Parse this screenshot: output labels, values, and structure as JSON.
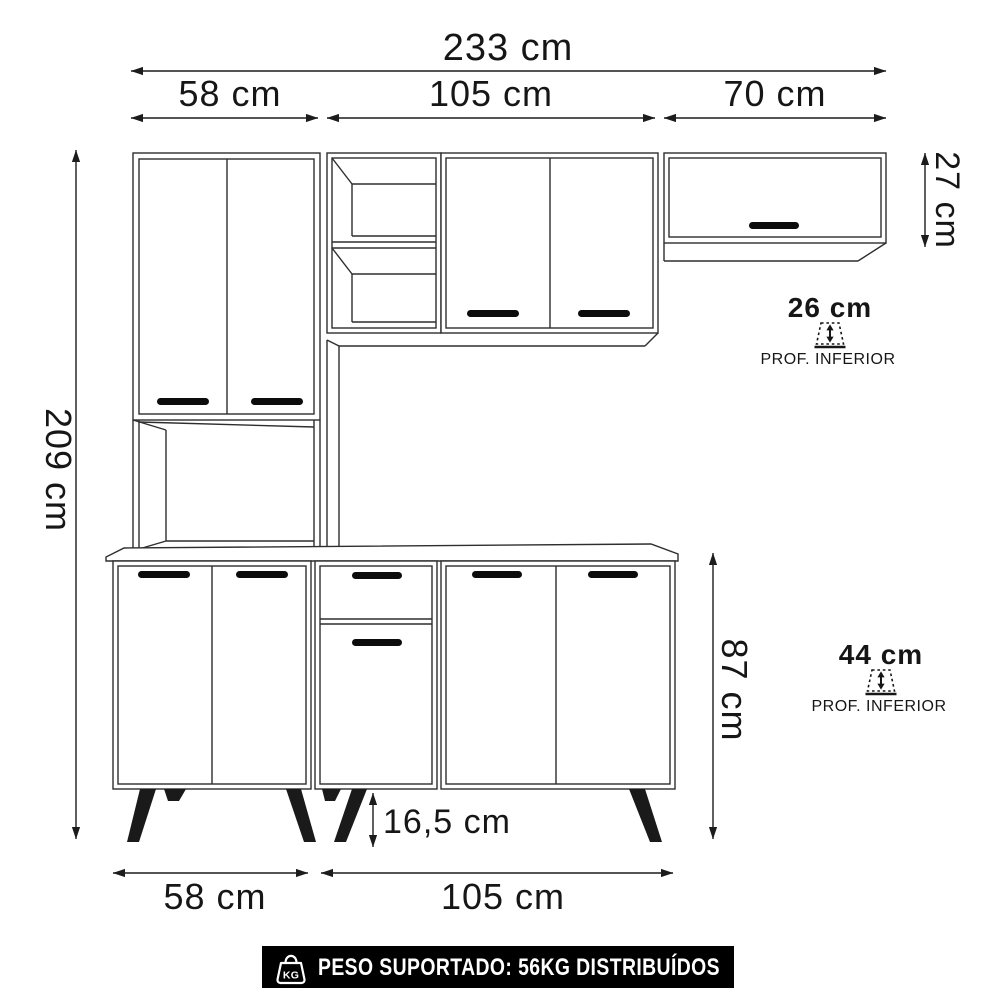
{
  "diagram": {
    "top_dimensions": {
      "total_width": "233 cm",
      "left_width": "58 cm",
      "middle_width": "105 cm",
      "right_width": "70 cm"
    },
    "side_dimensions": {
      "total_height": "209 cm",
      "upper_right_cabinet_height": "27 cm",
      "base_height": "87 cm",
      "leg_height": "16,5 cm"
    },
    "depth_annotations": {
      "upper": {
        "value": "26 cm",
        "label": "PROF. INFERIOR",
        "icon": "depth-arrow-icon"
      },
      "lower": {
        "value": "44 cm",
        "label": "PROF. INFERIOR",
        "icon": "depth-arrow-icon"
      }
    },
    "bottom_dimensions": {
      "left_width": "58 cm",
      "middle_width": "105 cm"
    },
    "footer": {
      "icon": "kg-weight-icon",
      "icon_text": "KG",
      "text": "PESO SUPORTADO: 56KG DISTRIBUÍDOS",
      "bg_color": "#000000",
      "text_color": "#ffffff"
    },
    "colors": {
      "background": "#ffffff",
      "furniture_lines": "#2e2e2e",
      "dimension_lines": "#1c1c1c",
      "handles": "#0c0c0c",
      "legs": "#1a1a1a"
    }
  }
}
